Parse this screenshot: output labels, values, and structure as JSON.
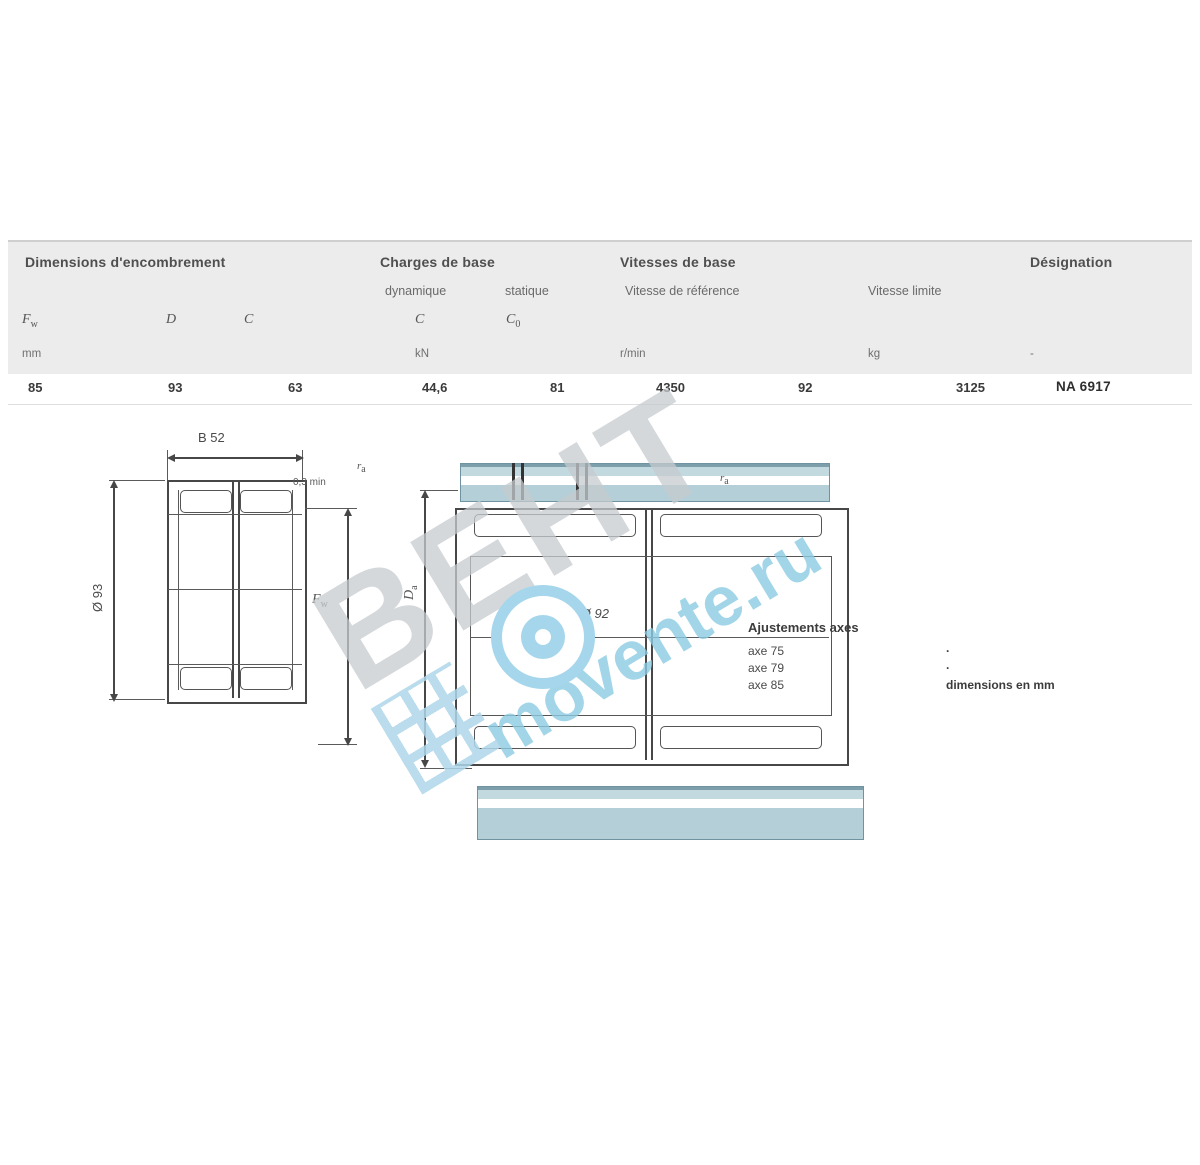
{
  "table": {
    "groups": {
      "dimensions": "Dimensions d'encombrement",
      "loads": "Charges de base",
      "speeds": "Vitesses de base",
      "designation": "Désignation"
    },
    "subheaders": {
      "dynamic": "dynamique",
      "static": "statique",
      "ref_speed": "Vitesse de référence",
      "lim_speed": "Vitesse limite"
    },
    "symbols": {
      "fw_base": "F",
      "fw_sub": "w",
      "d": "D",
      "c": "C",
      "c_dyn": "C",
      "c0_base": "C",
      "c0_sub": "0"
    },
    "units": {
      "mm": "mm",
      "kn": "kN",
      "rpm": "r/min",
      "kg": "kg",
      "dash": "-"
    },
    "row": {
      "fw": "85",
      "d": "93",
      "c": "63",
      "c_dyn": "44,6",
      "c0": "81",
      "ref_speed": "4350",
      "lim_speed": "92",
      "mass": "3125",
      "designation": "NA 6917"
    }
  },
  "drawing_left": {
    "width_dim": "B 52",
    "outer_dia_dim": "Ø 93",
    "fw_base": "F",
    "fw_sub": "w",
    "chamfer": "0,3 min",
    "ra_base": "r",
    "ra_sub": "a"
  },
  "drawing_right": {
    "da_base": "D",
    "da_sub": "a",
    "bore_dim": "≤ Ø 92",
    "ra_base": "r",
    "ra_sub": "a"
  },
  "fits_note": {
    "title": "Ajustements axes",
    "rows": [
      {
        "label": "axe 75",
        "value": "·"
      },
      {
        "label": "axe 79",
        "value": "·"
      },
      {
        "label": "axe 85",
        "value": "dimensions en mm"
      }
    ]
  },
  "watermark": {
    "brand": "ВЕНТ",
    "site": "movente.ru"
  },
  "colors": {
    "accent_teal": "#b5cfd8",
    "watermark_gray": "#c6cbce",
    "watermark_blue": "#8ccbe2"
  }
}
